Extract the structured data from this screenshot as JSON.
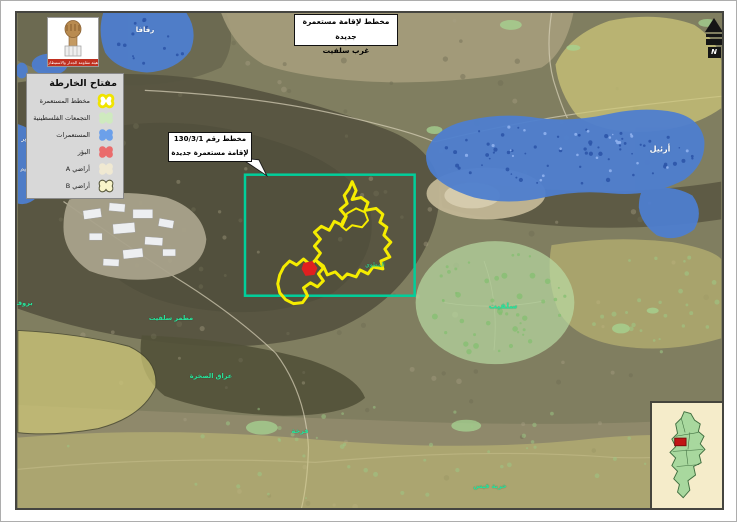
{
  "page": {
    "background": "#ffffff"
  },
  "title_box": {
    "line1": "مخطط لإقامة مستعمرة جديدة",
    "line2": "غرب سلفيت"
  },
  "logo": {
    "org_name": "هيئة مقاومة الجدار والاستيطان"
  },
  "legend": {
    "title": "مفتاح الخارطة",
    "items": [
      {
        "key": "settlement-plan",
        "label": "مخطط المستعمرة",
        "fill": "#ffffff",
        "stroke": "#f0e400",
        "stroke_width": 3.2
      },
      {
        "key": "palestinian-communities",
        "label": "التجمعات الفلسطينية",
        "fill": "#cfeabf",
        "stroke": "none",
        "stroke_width": 0
      },
      {
        "key": "settlements",
        "label": "المستعمرات",
        "fill": "#6ca0ea",
        "stroke": "none",
        "stroke_width": 0
      },
      {
        "key": "outposts",
        "label": "البؤر",
        "fill": "#ea6c6c",
        "stroke": "none",
        "stroke_width": 0
      },
      {
        "key": "areas-a",
        "label": "أراضي A",
        "fill": "#f0e9d2",
        "stroke": "none",
        "stroke_width": 0
      },
      {
        "key": "areas-b",
        "label": "أراضي B",
        "fill": "#f8f4c9",
        "stroke": "#55553a",
        "stroke_width": 1.2
      }
    ]
  },
  "callout": {
    "line1": "مخطط رقم 130/3/1",
    "line2": "لإقامة مستعمرة جديدة"
  },
  "north_arrow": {
    "label": "N"
  },
  "inset": {
    "marker_color": "#c11515"
  },
  "colors": {
    "plan_outline": "#f5ec00",
    "boundary_box": "#00cf9b",
    "outpost_red": "#e01f1f",
    "settlement_blue": "#4e7ecf",
    "community_green": "#b9dda3",
    "area_b_khaki": "#cfc878",
    "area_a_cream": "#efe8cf",
    "label_teal": "#27e59c"
  },
  "map_labels": [
    {
      "id": "revava",
      "text": "رفافا",
      "x": 128,
      "y": 17,
      "color": "#ffffff",
      "size": 7,
      "bold": true
    },
    {
      "id": "ariel",
      "text": "أرئيل",
      "x": 643,
      "y": 136,
      "color": "#ffffff",
      "size": 8,
      "bold": true
    },
    {
      "id": "yakir",
      "text": "ياكير",
      "x": 10,
      "y": 126,
      "color": "#ffffff",
      "size": 6,
      "bold": false
    },
    {
      "id": "nofim",
      "text": "نوفيم",
      "x": 10,
      "y": 156,
      "color": "#ffffff",
      "size": 6,
      "bold": false
    },
    {
      "id": "salfit",
      "text": "سلفيت",
      "x": 486,
      "y": 293,
      "color": "#27e59c",
      "size": 8,
      "bold": true
    },
    {
      "id": "matmar-salfit",
      "text": "مطمر سلفيت",
      "x": 154,
      "y": 305,
      "color": "#27e59c",
      "size": 6.5,
      "bold": true
    },
    {
      "id": "iraq-as-sakhra",
      "text": "عراق الصخرة",
      "x": 194,
      "y": 363,
      "color": "#27e59c",
      "size": 6.5,
      "bold": true
    },
    {
      "id": "farkha",
      "text": "فرخة",
      "x": 283,
      "y": 418,
      "color": "#27e59c",
      "size": 6.5,
      "bold": true
    },
    {
      "id": "khirbet-qais",
      "text": "خربة قيس",
      "x": 473,
      "y": 473,
      "color": "#27e59c",
      "size": 6.5,
      "bold": true
    },
    {
      "id": "bruqin",
      "text": "بروقين",
      "x": 4,
      "y": 290,
      "color": "#27e59c",
      "size": 6.5,
      "bold": true
    },
    {
      "id": "al-matwi",
      "text": "المطوي",
      "x": 358,
      "y": 252,
      "color": "#27e59c",
      "size": 6,
      "bold": false
    }
  ]
}
